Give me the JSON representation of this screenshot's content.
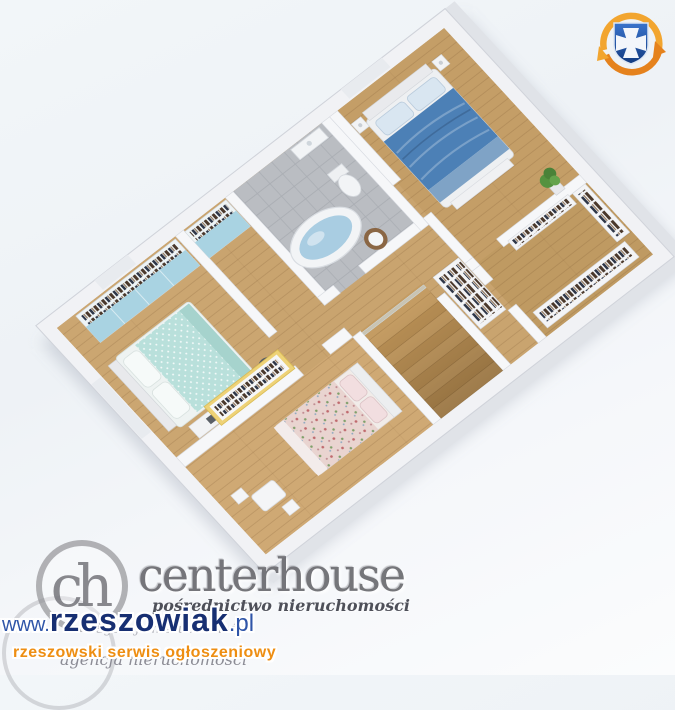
{
  "colors": {
    "wood": "#c9a46f",
    "wood-mint": "#cba671",
    "wood-child": "#cfa974",
    "wood-master": "#c49e67",
    "wood-closet": "#bf9a62",
    "tile": "#babdc2",
    "wall": "#f6f7f9",
    "slab": "#f1f2f5",
    "wall-face": "#e0e3e8",
    "bed-blue": "#4c80b6",
    "bed-blue-foot": "#7fa3c6",
    "pillow-blue": "#d9e6f1",
    "bed-mint": "#b9e0db",
    "bed-mint-edge": "#a6d3cd",
    "bed-floral": "#e9d4d0",
    "pillow-pink": "#f2dee0",
    "cabinet-blue": "#a9d3e2",
    "wardrobe-yellow": "#eed277",
    "water": "#a9cde2",
    "fixture": "#f2f4f6",
    "stool": "#8a6644",
    "stair": "#c49c63",
    "stair-dark": "#b88f55",
    "plant": "#55923f",
    "white-furn": "#f3f4f6",
    "wm-gray": "#6b6b70",
    "wm-tagline": "#3c3e48",
    "wm-agency": "#8c8c95",
    "wm-url": "#172f72",
    "wm-url-light": "#2f55a8",
    "wm-orange": "#ee8e12",
    "crest-blue": "#123a80",
    "crest-blue-light": "#3a74cc",
    "crest-orange": "#e5821d",
    "crest-yellow": "#f2a52f",
    "crest-cross": "#f3f6fb"
  },
  "floorplan": {
    "description": "3D isometric apartment floor plan render",
    "rooms": [
      {
        "name": "bedroom-mint"
      },
      {
        "name": "child-bedroom"
      },
      {
        "name": "bathroom"
      },
      {
        "name": "hallway"
      },
      {
        "name": "master-bedroom"
      },
      {
        "name": "walk-in-closet"
      },
      {
        "name": "staircase"
      }
    ]
  },
  "watermarks": {
    "centerhouse": {
      "monogram": "ch",
      "brand": "centerhouse",
      "tagline": "pośrednictwo nieruchomości",
      "agency_faint": "agencja nieruchomości",
      "agency": "agencja nieruchomości"
    },
    "rzeszowiak": {
      "www": "www.",
      "name": "rzeszowiak",
      "tld": ".pl",
      "slogan": "rzeszowski serwis ogłoszeniowy"
    }
  }
}
